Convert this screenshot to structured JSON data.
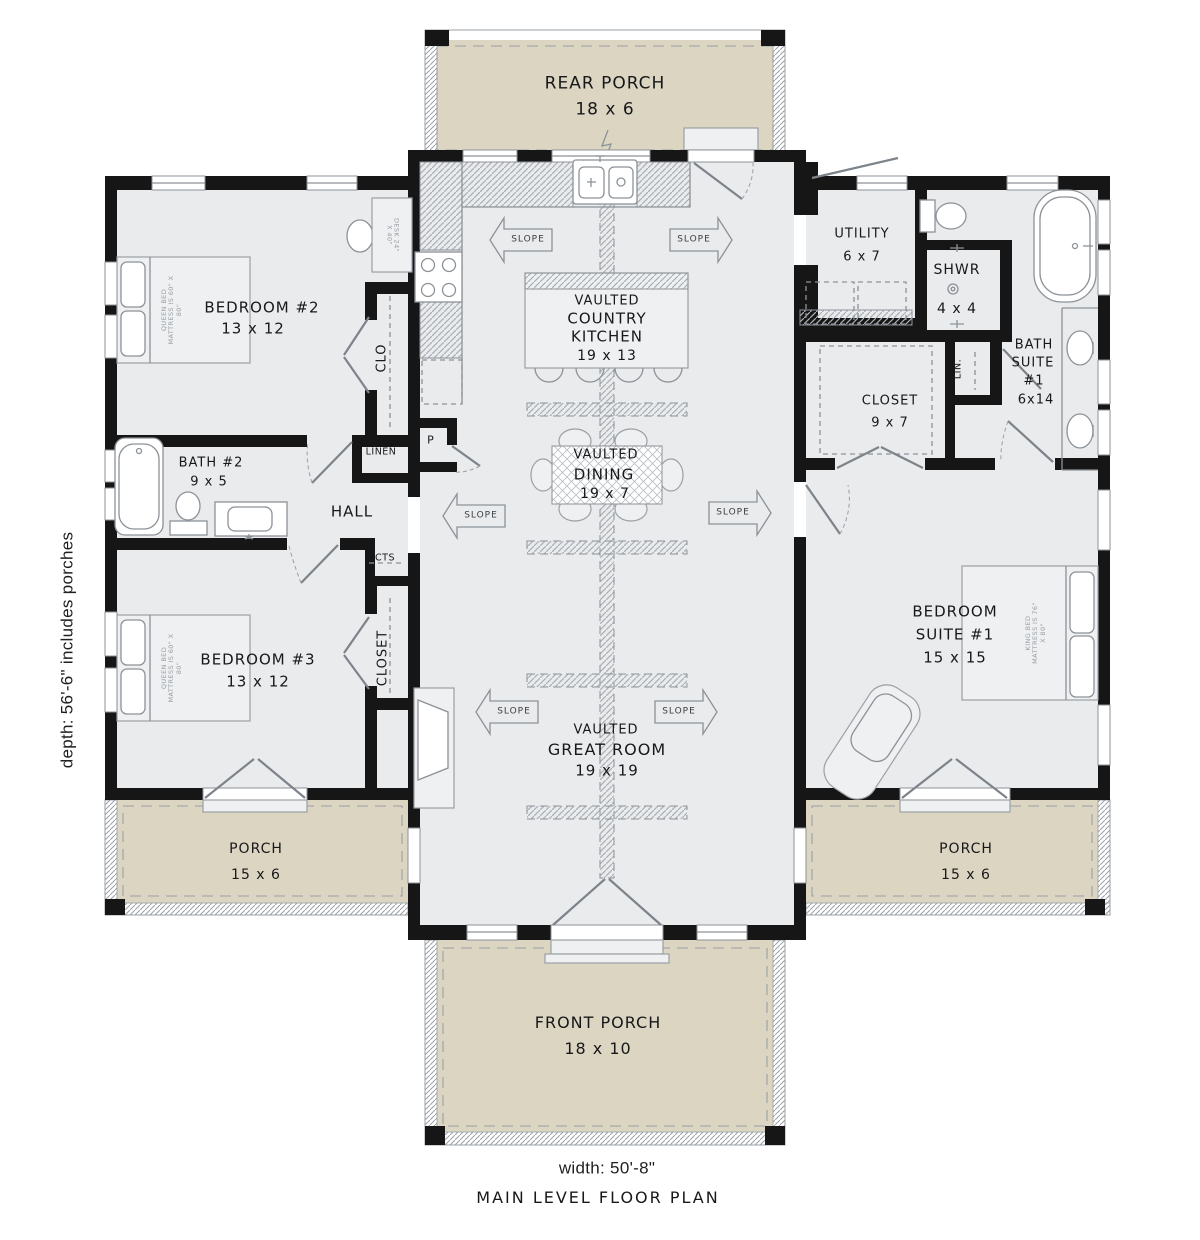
{
  "labels": {
    "slope": "SLOPE",
    "rear_porch": {
      "name": "REAR PORCH",
      "dims": "18 x 6"
    },
    "front_porch": {
      "name": "FRONT PORCH",
      "dims": "18 x 10"
    },
    "left_porch": {
      "name": "PORCH",
      "dims": "15 x 6"
    },
    "right_porch": {
      "name": "PORCH",
      "dims": "15 x 6"
    },
    "kitchen": {
      "l1": "VAULTED",
      "l2": "COUNTRY",
      "l3": "KITCHEN",
      "dims": "19 x 13"
    },
    "dining": {
      "l1": "VAULTED",
      "l2": "DINING",
      "dims": "19 x 7"
    },
    "great_room": {
      "l1": "VAULTED",
      "l2": "GREAT ROOM",
      "dims": "19 x 19"
    },
    "bedroom2": {
      "name": "BEDROOM #2",
      "dims": "13 x 12"
    },
    "bedroom3": {
      "name": "BEDROOM #3",
      "dims": "13 x 12"
    },
    "bedroom_suite": {
      "l1": "BEDROOM",
      "l2": "SUITE #1",
      "dims": "15 x 15"
    },
    "bath2": {
      "name": "BATH #2",
      "dims": "9 x 5"
    },
    "bath_suite": {
      "l1": "BATH",
      "l2": "SUITE",
      "l3": "#1",
      "dims": "6x14"
    },
    "utility": {
      "name": "UTILITY",
      "dims": "6 x 7"
    },
    "shower": {
      "name": "SHWR",
      "dims": "4 x 4"
    },
    "closet_suite": {
      "name": "CLOSET",
      "dims": "9 x 7"
    },
    "hall": "HALL",
    "linen": "LINEN",
    "pantry": "P",
    "coats": "CTS",
    "clo": "CLO",
    "closet": "CLOSET",
    "lin": "LIN.",
    "queen_bed": "QUEEN BED MATTRESS IS 60\" X 80\"",
    "king_bed": "KING BED MATTRESS IS 76\" X 80\"",
    "desk": "DESK 24\" X 40\""
  },
  "footer": {
    "width": "width: 50'-8\"",
    "title": "MAIN LEVEL FLOOR PLAN"
  },
  "side_note": "depth: 56'-6\" includes porches",
  "colors": {
    "wall": "#161616",
    "interior": "#e9ebec",
    "porch": "#dcd5c2",
    "line": "#8d9298"
  }
}
